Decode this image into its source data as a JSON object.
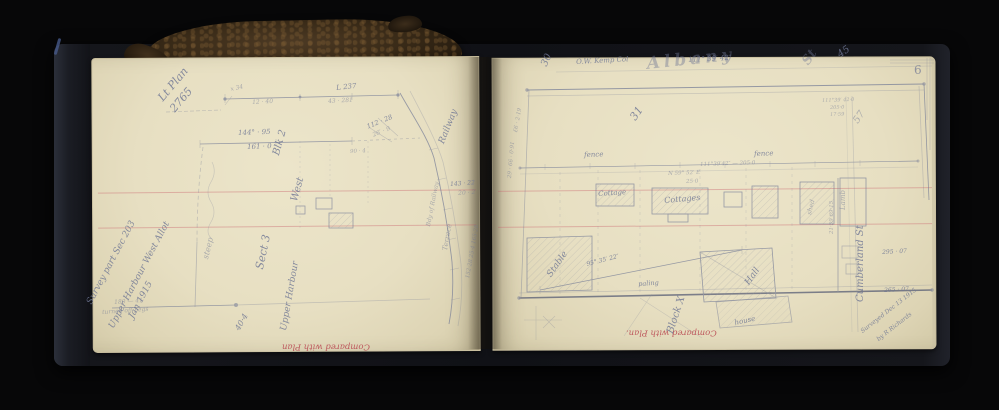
{
  "scene": {
    "subject": "open surveyor's field notebook photographed on black background",
    "background_color": "#070708",
    "cover_color": "#1a1c22",
    "page_color": "#e9e2c6",
    "pencil_color": "#6e7694",
    "red_ink_color": "#b8434e",
    "rule_color": "#cd6e76",
    "strap_color": "#3f2f1d"
  },
  "left_page": {
    "red_stamp": "Compared with Plan",
    "annotations": [
      {
        "t": "Survey part Sec 203",
        "x": 86,
        "y": 302,
        "r": -62,
        "s": 9,
        "c": "script"
      },
      {
        "t": "Upper Harbour West Allot",
        "x": 108,
        "y": 326,
        "r": -62,
        "s": 9,
        "c": "script"
      },
      {
        "t": "Jan 1915",
        "x": 128,
        "y": 316,
        "r": -62,
        "s": 9,
        "c": "script"
      },
      {
        "t": "Lt Plan",
        "x": 156,
        "y": 96,
        "r": -50,
        "s": 11,
        "c": "script"
      },
      {
        "t": "2765",
        "x": 168,
        "y": 107,
        "r": -50,
        "s": 11,
        "c": "script"
      },
      {
        "t": "L 237",
        "x": 336,
        "y": 85,
        "r": -6,
        "s": 7
      },
      {
        "t": "43 · 281",
        "x": 328,
        "y": 99,
        "r": -3,
        "s": 6,
        "c": "faint"
      },
      {
        "t": "12 · 40",
        "x": 252,
        "y": 100,
        "r": -3,
        "s": 6,
        "c": "faint"
      },
      {
        "t": "x 34",
        "x": 230,
        "y": 87,
        "r": -12,
        "s": 6,
        "c": "faint"
      },
      {
        "t": "144° · 95",
        "x": 238,
        "y": 130,
        "r": -2,
        "s": 7
      },
      {
        "t": "161 · 0",
        "x": 247,
        "y": 144,
        "r": -2,
        "s": 7
      },
      {
        "t": "Blk 2",
        "x": 272,
        "y": 154,
        "r": -74,
        "s": 10,
        "c": "script"
      },
      {
        "t": "West",
        "x": 290,
        "y": 200,
        "r": -74,
        "s": 10,
        "c": "script"
      },
      {
        "t": "Sect 3",
        "x": 254,
        "y": 268,
        "r": -78,
        "s": 11,
        "c": "script"
      },
      {
        "t": "Upper Harbour",
        "x": 280,
        "y": 330,
        "r": -80,
        "s": 9,
        "c": "script"
      },
      {
        "t": "steep",
        "x": 202,
        "y": 258,
        "r": -76,
        "s": 8,
        "c": "faint"
      },
      {
        "t": "Railway",
        "x": 438,
        "y": 142,
        "r": -68,
        "s": 9,
        "c": "script"
      },
      {
        "t": "Bdy of Railway",
        "x": 426,
        "y": 226,
        "r": -79,
        "s": 6,
        "c": "faint"
      },
      {
        "t": "Terrace",
        "x": 442,
        "y": 250,
        "r": -80,
        "s": 7,
        "c": "faint"
      },
      {
        "t": "152·28  25·4  165·28",
        "x": 466,
        "y": 278,
        "r": -80,
        "s": 5.5,
        "c": "faint"
      },
      {
        "t": "143 · 22",
        "x": 450,
        "y": 182,
        "r": -4,
        "s": 6
      },
      {
        "t": "20 · 2",
        "x": 458,
        "y": 191,
        "r": -4,
        "s": 6,
        "c": "faint"
      },
      {
        "t": "112 · 28",
        "x": 366,
        "y": 124,
        "r": -22,
        "s": 6.5
      },
      {
        "t": "26′ · 9",
        "x": 372,
        "y": 133,
        "r": -22,
        "s": 6,
        "c": "faint"
      },
      {
        "t": "90 · 4",
        "x": 350,
        "y": 150,
        "r": -3,
        "s": 5.5,
        "c": "faint"
      },
      {
        "t": "180 — 41",
        "x": 114,
        "y": 300,
        "r": -4,
        "s": 6,
        "c": "faint"
      },
      {
        "t": "turned off pegs",
        "x": 102,
        "y": 310,
        "r": -4,
        "s": 6,
        "c": "faint"
      },
      {
        "t": "40·4",
        "x": 234,
        "y": 328,
        "r": -60,
        "s": 8,
        "c": "script"
      },
      {
        "t": "Compared with Plan",
        "x": 282,
        "y": 342,
        "r": 180,
        "s": 8.5,
        "c": "red"
      }
    ]
  },
  "right_page": {
    "page_number": "6",
    "red_stamp": "Compared with Plan.",
    "annotations": [
      {
        "t": "6",
        "x": 914,
        "y": 64,
        "r": 0,
        "s": 12,
        "c": "pagenum"
      },
      {
        "t": "O.W. Kemp Col",
        "x": 576,
        "y": 59,
        "r": -3,
        "s": 7,
        "c": "script"
      },
      {
        "t": "111° 39′ 42″",
        "x": 688,
        "y": 57,
        "r": -3,
        "s": 7
      },
      {
        "t": "Albany",
        "x": 646,
        "y": 56,
        "r": -6,
        "s": 17,
        "ls": 4,
        "c": "big"
      },
      {
        "t": "St",
        "x": 800,
        "y": 60,
        "r": -55,
        "s": 13,
        "c": "big"
      },
      {
        "t": "45",
        "x": 836,
        "y": 52,
        "r": -35,
        "s": 10,
        "c": "script"
      },
      {
        "t": "30",
        "x": 540,
        "y": 64,
        "r": -65,
        "s": 10,
        "c": "script"
      },
      {
        "t": "31",
        "x": 628,
        "y": 116,
        "r": -55,
        "s": 11,
        "c": "script"
      },
      {
        "t": "fence",
        "x": 584,
        "y": 152,
        "r": -2,
        "s": 7,
        "c": "script"
      },
      {
        "t": "fence",
        "x": 754,
        "y": 151,
        "r": -2,
        "s": 7,
        "c": "script"
      },
      {
        "t": "111°39′42″ — 205·0",
        "x": 700,
        "y": 163,
        "r": -2,
        "s": 5.5,
        "c": "faint"
      },
      {
        "t": "Cottage",
        "x": 598,
        "y": 191,
        "r": -4,
        "s": 7,
        "c": "script"
      },
      {
        "t": "Cottages",
        "x": 664,
        "y": 197,
        "r": -5,
        "s": 8,
        "c": "script"
      },
      {
        "t": "shed",
        "x": 806,
        "y": 214,
        "r": -76,
        "s": 6.5,
        "c": "faint"
      },
      {
        "t": "N 59° 52′ E",
        "x": 668,
        "y": 172,
        "r": -2,
        "s": 5.5,
        "c": "faint"
      },
      {
        "t": "25·0",
        "x": 686,
        "y": 180,
        "r": -2,
        "s": 5.5,
        "c": "faint"
      },
      {
        "t": "Stable",
        "x": 546,
        "y": 274,
        "r": -55,
        "s": 9,
        "c": "script"
      },
      {
        "t": "95° 35′ 22″",
        "x": 586,
        "y": 262,
        "r": -14,
        "s": 6
      },
      {
        "t": "paling",
        "x": 638,
        "y": 281,
        "r": -4,
        "s": 6.5,
        "c": "script"
      },
      {
        "t": "Block X",
        "x": 666,
        "y": 332,
        "r": -72,
        "s": 10,
        "c": "script"
      },
      {
        "t": "Hall",
        "x": 744,
        "y": 282,
        "r": -55,
        "s": 9,
        "c": "script"
      },
      {
        "t": "house",
        "x": 734,
        "y": 320,
        "r": -12,
        "s": 7,
        "c": "script"
      },
      {
        "t": "295 · 07",
        "x": 882,
        "y": 250,
        "r": -3,
        "s": 6
      },
      {
        "t": "265 · 07",
        "x": 884,
        "y": 288,
        "r": -3,
        "s": 6
      },
      {
        "t": "Cumberland St",
        "x": 856,
        "y": 302,
        "r": -90,
        "s": 10,
        "c": "script"
      },
      {
        "t": "Lamb",
        "x": 840,
        "y": 210,
        "r": -90,
        "s": 7,
        "c": "faint"
      },
      {
        "t": "21·59  69·15",
        "x": 830,
        "y": 234,
        "r": -90,
        "s": 5.5,
        "c": "faint"
      },
      {
        "t": "57",
        "x": 852,
        "y": 120,
        "r": -55,
        "s": 10,
        "c": "faint"
      },
      {
        "t": "111°39′ 42·0",
        "x": 822,
        "y": 99,
        "r": -2,
        "s": 5,
        "c": "faint"
      },
      {
        "t": "205·0",
        "x": 830,
        "y": 106,
        "r": -2,
        "s": 5,
        "c": "faint"
      },
      {
        "t": "17·59",
        "x": 830,
        "y": 113,
        "r": -2,
        "s": 5,
        "c": "faint"
      },
      {
        "t": "29 · 66 · 0·91",
        "x": 508,
        "y": 178,
        "r": -85,
        "s": 5.5,
        "c": "faint"
      },
      {
        "t": "£6 · 2·19",
        "x": 514,
        "y": 132,
        "r": -80,
        "s": 5.5,
        "c": "faint"
      },
      {
        "t": "Surveyed Dec 13 1915",
        "x": 860,
        "y": 330,
        "r": -38,
        "s": 6,
        "c": "script"
      },
      {
        "t": "by R Richards",
        "x": 876,
        "y": 338,
        "r": -38,
        "s": 6,
        "c": "script"
      },
      {
        "t": "Compared with Plan.",
        "x": 626,
        "y": 328,
        "r": 180,
        "s": 8.5,
        "c": "red"
      }
    ]
  }
}
